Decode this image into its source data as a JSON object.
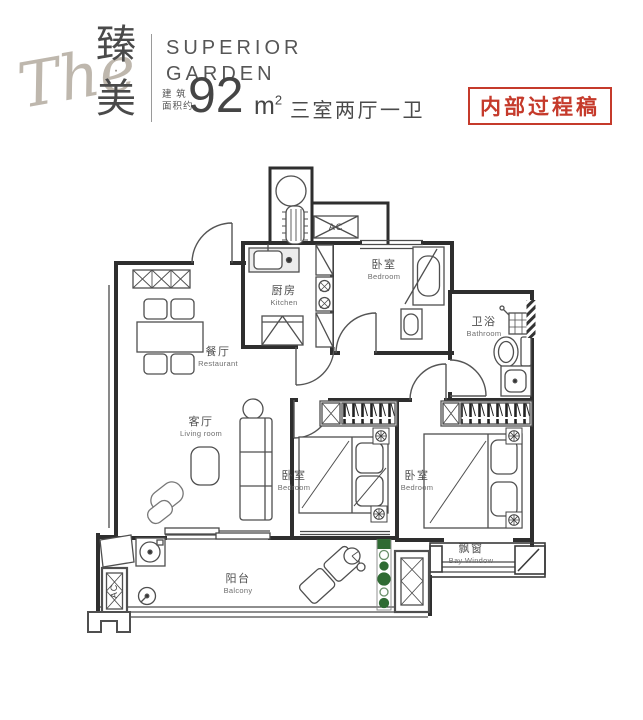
{
  "header": {
    "brand_script": "The",
    "brand_cn_top": "臻",
    "brand_cn_dot": "·",
    "brand_cn_bottom": "美",
    "brand_en_line1": "SUPERIOR",
    "brand_en_line2": "GARDEN",
    "area_prefix_line1": "建 筑",
    "area_prefix_line2": "面积约",
    "area_value": "92",
    "area_unit_base": "m",
    "area_unit_sup": "2",
    "layout_desc": "三室两厅一卫",
    "stamp": "内部过程稿"
  },
  "rooms": {
    "kitchen": {
      "zh": "厨房",
      "en": "Kitchen"
    },
    "bedroom_top": {
      "zh": "卧室",
      "en": "Bedroom"
    },
    "bathroom": {
      "zh": "卫浴",
      "en": "Bathroom"
    },
    "dining": {
      "zh": "餐厅",
      "en": "Restaurant"
    },
    "living": {
      "zh": "客厅",
      "en": "Living room"
    },
    "bedroom_middle": {
      "zh": "卧室",
      "en": "Bedroom"
    },
    "bedroom_right": {
      "zh": "卧室",
      "en": "Bedroom"
    },
    "balcony": {
      "zh": "阳台",
      "en": "Balcony"
    },
    "bay_window": {
      "zh": "飘窗",
      "en": "Bay Window"
    }
  },
  "annotations": {
    "ac_label": "AC"
  },
  "colors": {
    "wall_line": "#2e2e2e",
    "stamp_red": "#c53a2b",
    "plant_green": "#2f6b33",
    "brand_gray": "#beb7ad"
  }
}
